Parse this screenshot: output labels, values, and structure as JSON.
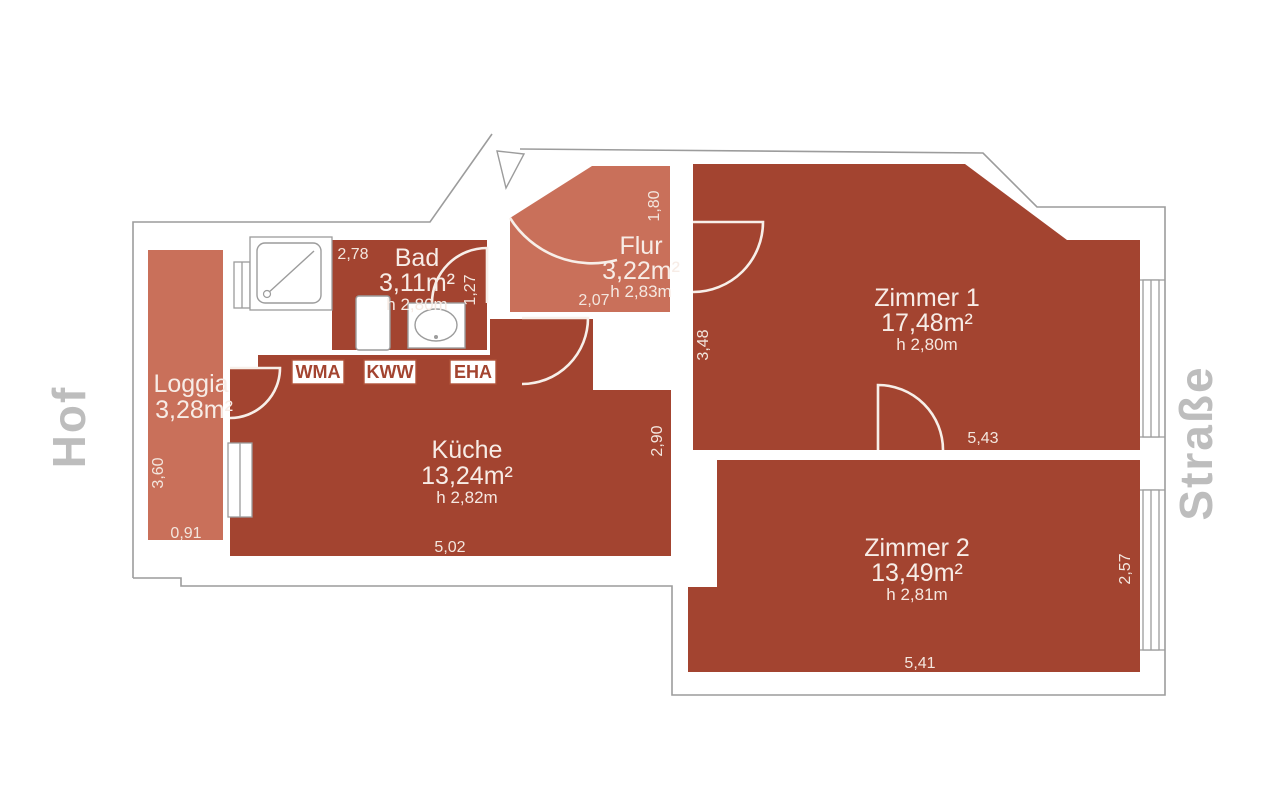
{
  "plan": {
    "surroundings": {
      "left": "Hof",
      "right": "Straße"
    },
    "rooms": {
      "loggia": {
        "name": "Loggia",
        "area": "3,28m²",
        "dim_v": "3,60",
        "dim_h": "0,91"
      },
      "bad": {
        "name": "Bad",
        "area": "3,11m²",
        "height": "h 2,80m",
        "dim_h": "2,78",
        "dim_v": "1,27"
      },
      "flur": {
        "name": "Flur",
        "area": "3,22m²",
        "height": "h 2,83m",
        "dim_v": "1,80",
        "dim_h": "2,07"
      },
      "kueche": {
        "name": "Küche",
        "area": "13,24m²",
        "height": "h 2,82m",
        "dim_v": "2,90",
        "dim_h": "5,02"
      },
      "zimmer1": {
        "name": "Zimmer 1",
        "area": "17,48m²",
        "height": "h 2,80m",
        "dim_v": "3,48",
        "dim_h": "5,43"
      },
      "zimmer2": {
        "name": "Zimmer 2",
        "area": "13,49m²",
        "height": "h 2,81m",
        "dim_h": "5,41",
        "dim_v": "2,57"
      }
    },
    "appliances": {
      "wma": "WMA",
      "kww": "KWW",
      "eha": "EHA"
    },
    "colors": {
      "room_dark": "#a34430",
      "room_light": "#c9705a",
      "outline_gray": "#9c9c9c",
      "side_label_gray": "#bdbdbd",
      "room_text": "#f7ece6"
    }
  }
}
